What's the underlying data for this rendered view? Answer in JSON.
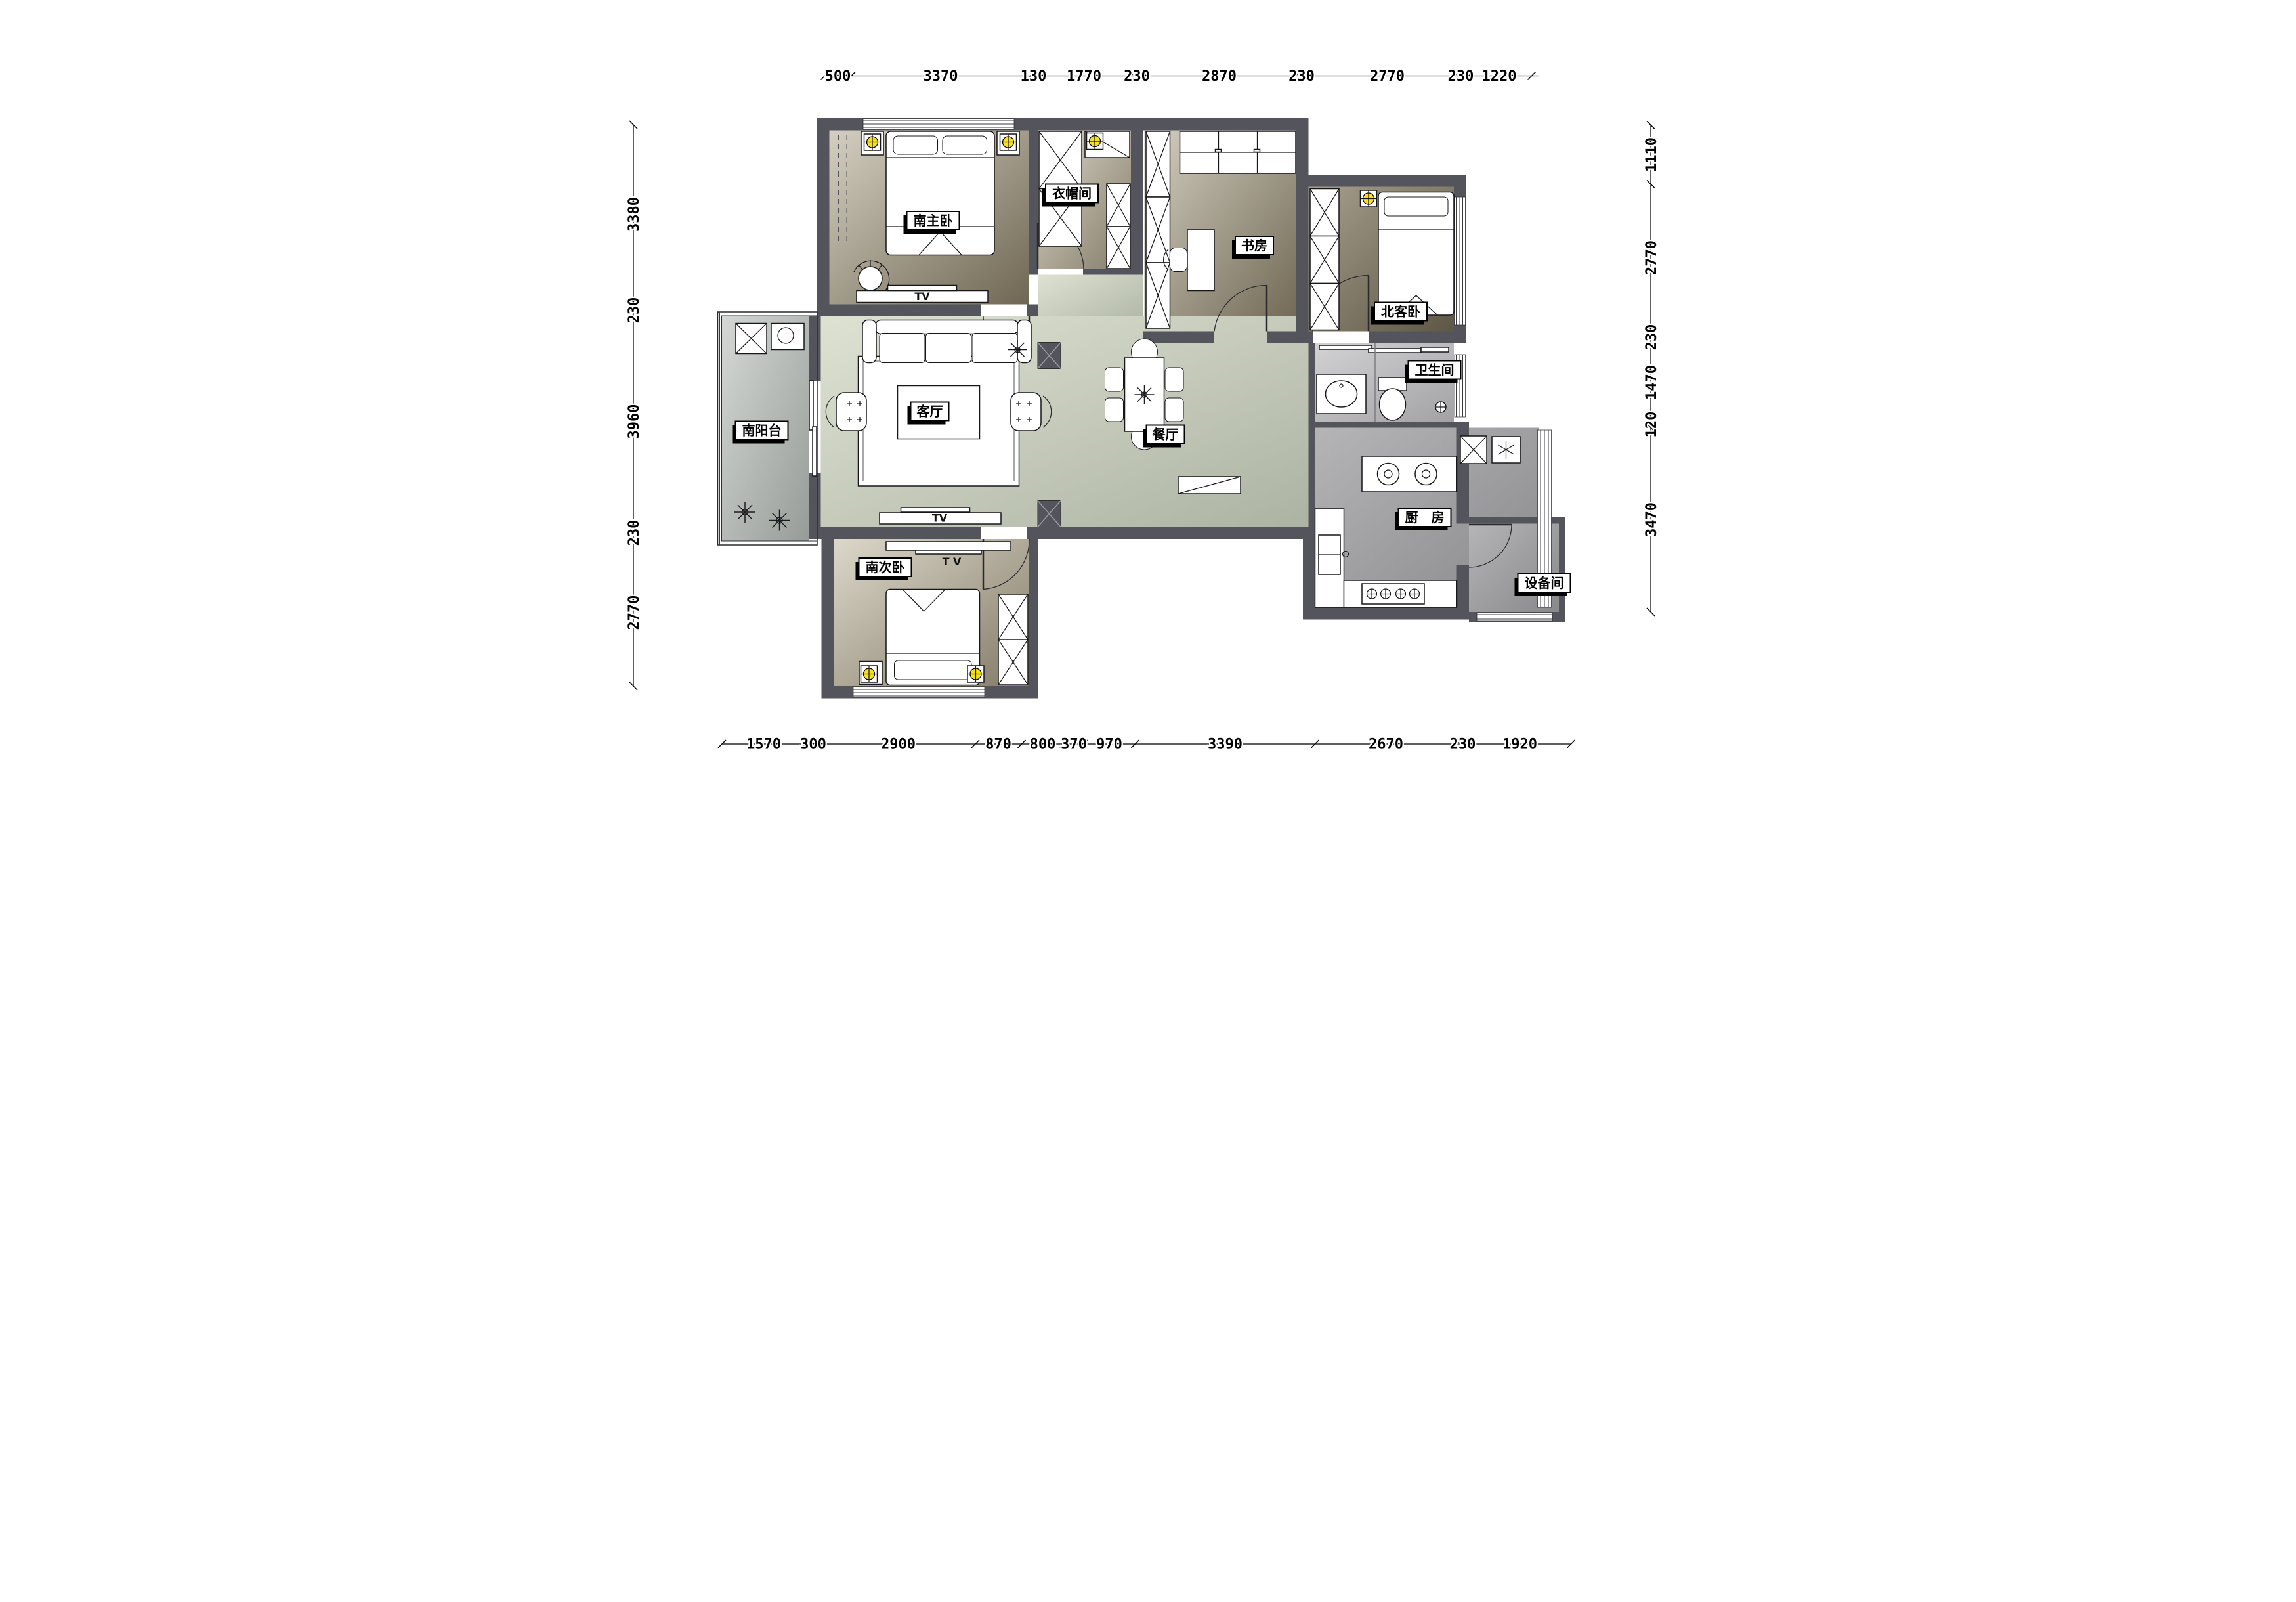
{
  "plan": {
    "type": "apartment-floor-plan",
    "unit": "mm",
    "colors": {
      "wall": "#54545c",
      "bedroom_floor_dark": "#6f6753",
      "bedroom_floor_light": "#d4cfc1",
      "living_floor": "#ccd2c1",
      "kitchen_floor": "#9b9b9d",
      "lamp_yellow": "#f8e11a",
      "label_bg": "#ffffff",
      "label_border": "#000000"
    }
  },
  "rooms": {
    "master_bedroom": {
      "label": "南主卧"
    },
    "cloakroom": {
      "label": "衣帽间"
    },
    "study": {
      "label": "书房"
    },
    "north_guest_bedroom": {
      "label": "北客卧"
    },
    "bathroom": {
      "label": "卫生间"
    },
    "living_room": {
      "label": "客厅"
    },
    "dining_room": {
      "label": "餐厅"
    },
    "kitchen": {
      "label": "厨　房"
    },
    "south_balcony": {
      "label": "南阳台"
    },
    "south_second_bedroom": {
      "label": "南次卧"
    },
    "equipment_room": {
      "label": "设备间"
    }
  },
  "annotations": {
    "tv": "TV",
    "tv_spaced": "T V"
  },
  "dimensions": {
    "unit": "mm",
    "top": [
      "500",
      "3370",
      "130",
      "1770",
      "230",
      "2870",
      "230",
      "2770",
      "230",
      "1220"
    ],
    "bottom": [
      "1570",
      "300",
      "2900",
      "870",
      "800",
      "370",
      "970",
      "3390",
      "2670",
      "230",
      "1920"
    ],
    "left": [
      "3380",
      "230",
      "3960",
      "230",
      "2770"
    ],
    "right": [
      "1110",
      "2770",
      "230",
      "1470",
      "120",
      "3470"
    ]
  }
}
